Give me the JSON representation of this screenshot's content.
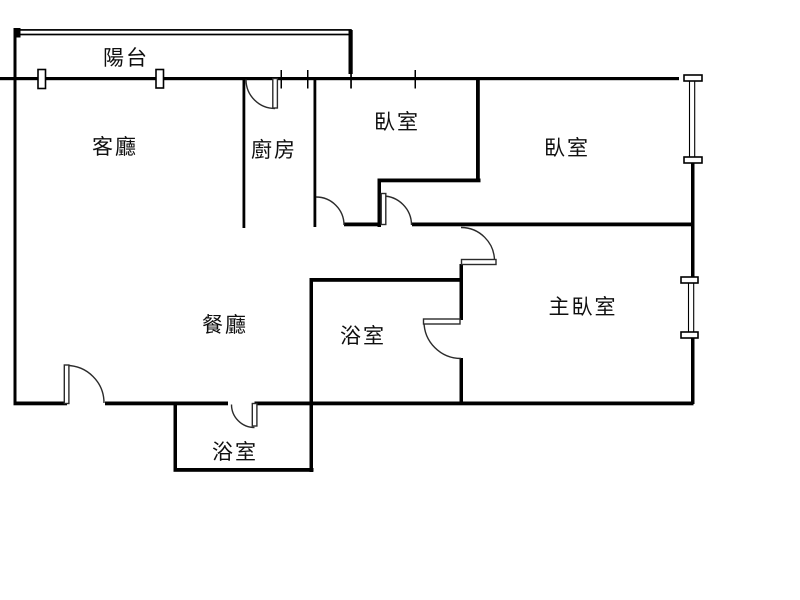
{
  "floorplan": {
    "colors": {
      "wall": "#000000",
      "door_arc": "#2b2b2b",
      "background": "#ffffff",
      "text": "#0f0f0f"
    },
    "rooms": [
      {
        "id": "balcony",
        "label": "陽台"
      },
      {
        "id": "living-room",
        "label": "客廳"
      },
      {
        "id": "kitchen",
        "label": "廚房"
      },
      {
        "id": "bedroom-1",
        "label": "臥室"
      },
      {
        "id": "bedroom-2",
        "label": "臥室"
      },
      {
        "id": "master-bedroom",
        "label": "主臥室"
      },
      {
        "id": "dining-room",
        "label": "餐廳"
      },
      {
        "id": "bathroom-1",
        "label": "浴室"
      },
      {
        "id": "bathroom-2",
        "label": "浴室"
      }
    ]
  }
}
